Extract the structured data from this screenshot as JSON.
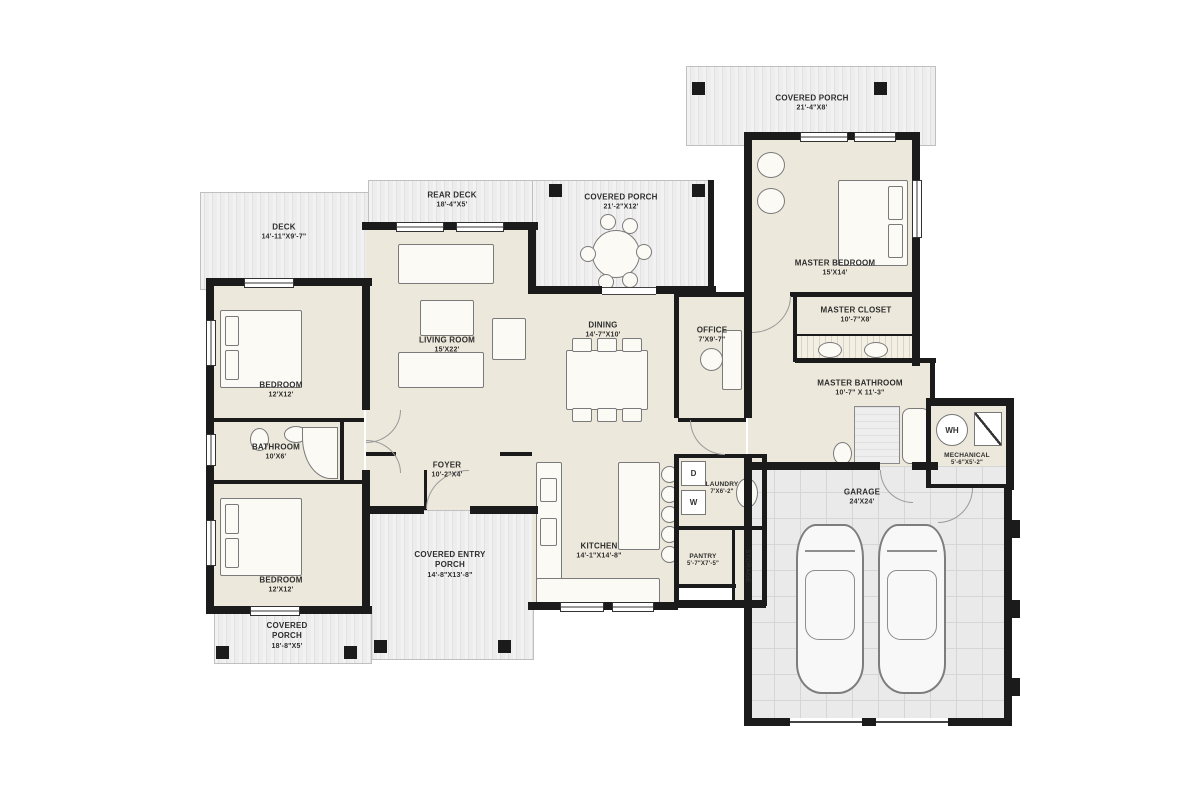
{
  "areas": {
    "covered_porch_top": {
      "name": "COVERED PORCH",
      "dims": "21'-4\"X8'"
    },
    "deck": {
      "name": "DECK",
      "dims": "14'-11\"X9'-7\""
    },
    "rear_deck": {
      "name": "REAR DECK",
      "dims": "18'-4\"X5'"
    },
    "covered_porch_center": {
      "name": "COVERED PORCH",
      "dims": "21'-2\"X12'"
    },
    "master_bedroom": {
      "name": "MASTER BEDROOM",
      "dims": "15'X14'"
    },
    "master_closet": {
      "name": "MASTER CLOSET",
      "dims": "10'-7\"X8'"
    },
    "master_bathroom": {
      "name": "MASTER BATHROOM",
      "dims": "10'-7\" X 11'-3\""
    },
    "living_room": {
      "name": "LIVING ROOM",
      "dims": "15'X22'"
    },
    "dining": {
      "name": "DINING",
      "dims": "14'-7\"X10'"
    },
    "office": {
      "name": "OFFICE",
      "dims": "7'X9'-7\""
    },
    "bedroom_top": {
      "name": "BEDROOM",
      "dims": "12'X12'"
    },
    "bathroom": {
      "name": "BATHROOM",
      "dims": "10'X6'"
    },
    "bedroom_bottom": {
      "name": "BEDROOM",
      "dims": "12'X12'"
    },
    "foyer": {
      "name": "FOYER",
      "dims": "10'-2\"X4'"
    },
    "covered_entry_porch": {
      "name": "COVERED ENTRY PORCH",
      "dims": "14'-8\"X13'-8\""
    },
    "kitchen": {
      "name": "KITCHEN",
      "dims": "14'-1\"X14'-8\""
    },
    "laundry": {
      "name": "LAUNDRY",
      "dims": "7'X6'-2\""
    },
    "pantry": {
      "name": "PANTRY",
      "dims": "5'-7\"X7'-5\""
    },
    "storage": {
      "name": "STORAGE"
    },
    "mechanical": {
      "name": "MECHANICAL",
      "dims": "5'-6\"X5'-2\""
    },
    "garage": {
      "name": "GARAGE",
      "dims": "24'X24'"
    },
    "covered_porch_bottom": {
      "name": "COVERED PORCH",
      "dims": "18'-8\"X5'"
    }
  },
  "appliances": {
    "washer": "W",
    "dryer": "D",
    "water_heater": "WH"
  },
  "colors": {
    "wall": "#1b1b1b",
    "room_fill": "#ece8db",
    "garage_tile": "#eaeaea"
  }
}
